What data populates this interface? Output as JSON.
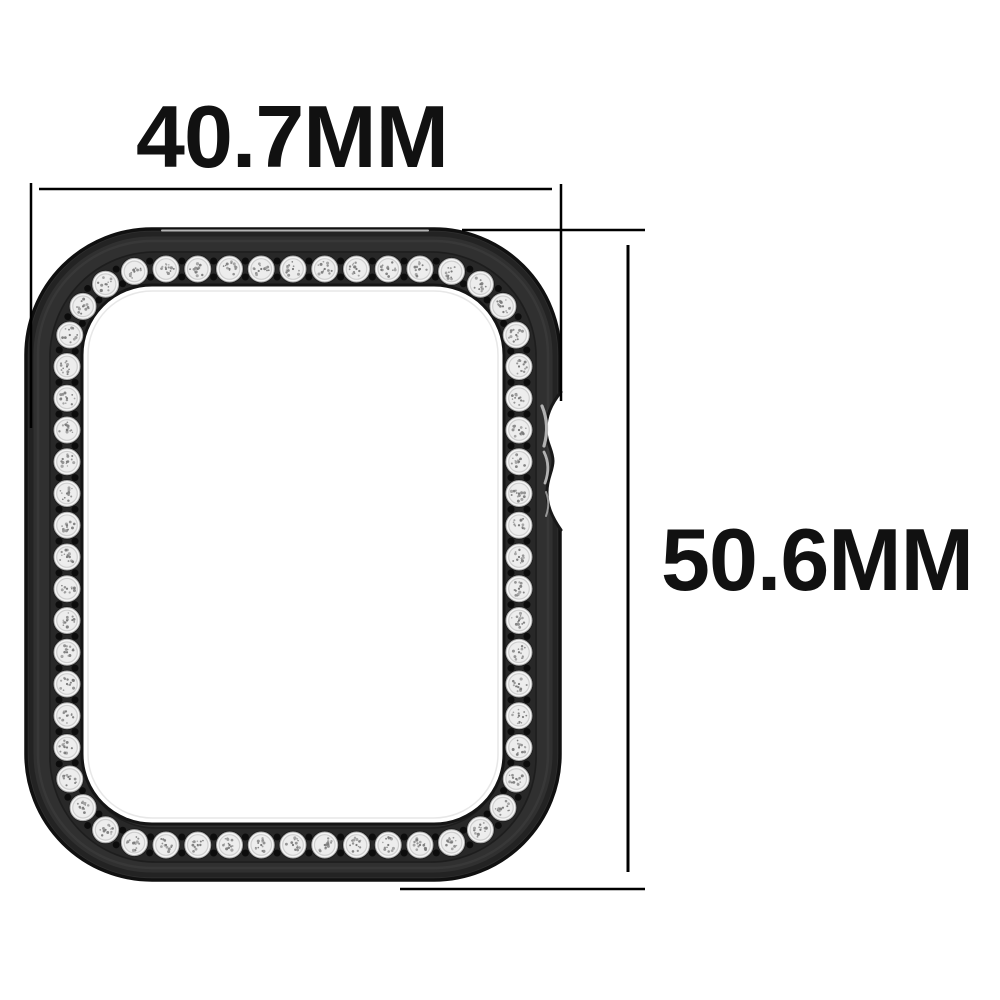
{
  "dimensions": {
    "width_label": "40.7MM",
    "height_label": "50.6MM"
  },
  "product": {
    "type": "watch protective case with rhinestone bezel",
    "stone_count": 60,
    "gap_dots_per_gap": 2
  },
  "colors": {
    "background": "#ffffff",
    "dimension_lines": "#000000",
    "label_text": "#111111",
    "case_body": "#303030",
    "case_edge": "#101010",
    "band": "#282828",
    "band_edge": "#1c1c1c",
    "opening_fill": "#ffffff",
    "opening_edge": "#151515",
    "stone_shadow": "#191919",
    "stone_base": "#f4f4f4",
    "stone_rim": "#a8a8a8",
    "stone_inner": "#ededed",
    "stone_inner_rim": "#cfcfcf",
    "stone_speckle": "#8a8a8a",
    "gap_dot": "#0c0c0c",
    "top_highlight": "#c6c6c6",
    "notch_highlight": "#b2b2b2"
  }
}
